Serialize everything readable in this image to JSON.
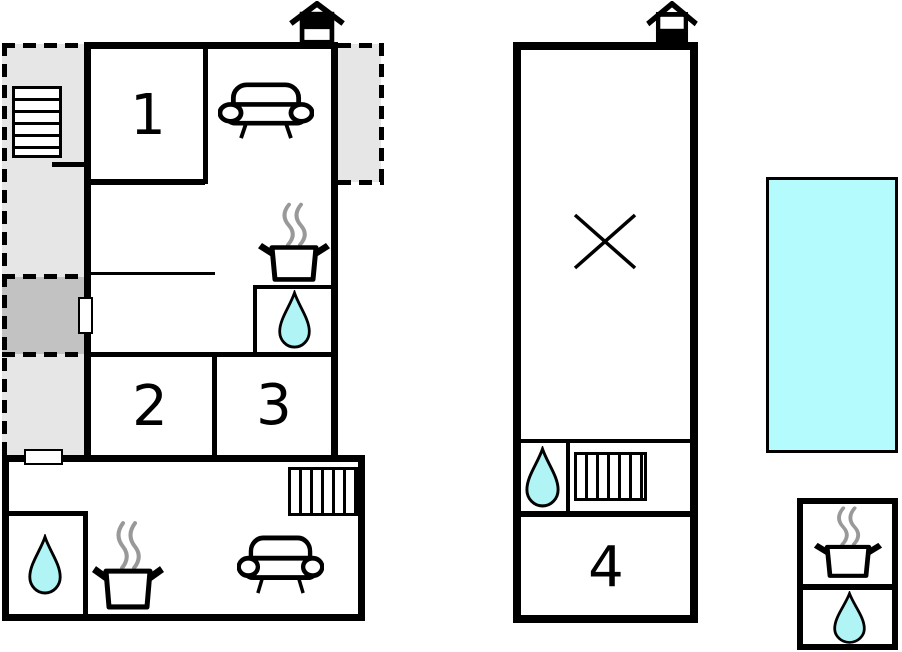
{
  "title": "Holiday home floor plan",
  "colors": {
    "wall": "#000000",
    "light_gray": "#e6e6e6",
    "dark_gray": "#c2c2c2",
    "water": "#b0f4f6",
    "pool": "#b4fbfd",
    "steam": "#999999"
  },
  "rooms": {
    "room1": "1",
    "room2": "2",
    "room3": "3",
    "room4": "4"
  },
  "icons": [
    "stairs-icon",
    "chimney-icon",
    "sofa-icon",
    "stove-pot-icon",
    "water-drop-icon",
    "radiator-icon",
    "x-mark-icon"
  ]
}
